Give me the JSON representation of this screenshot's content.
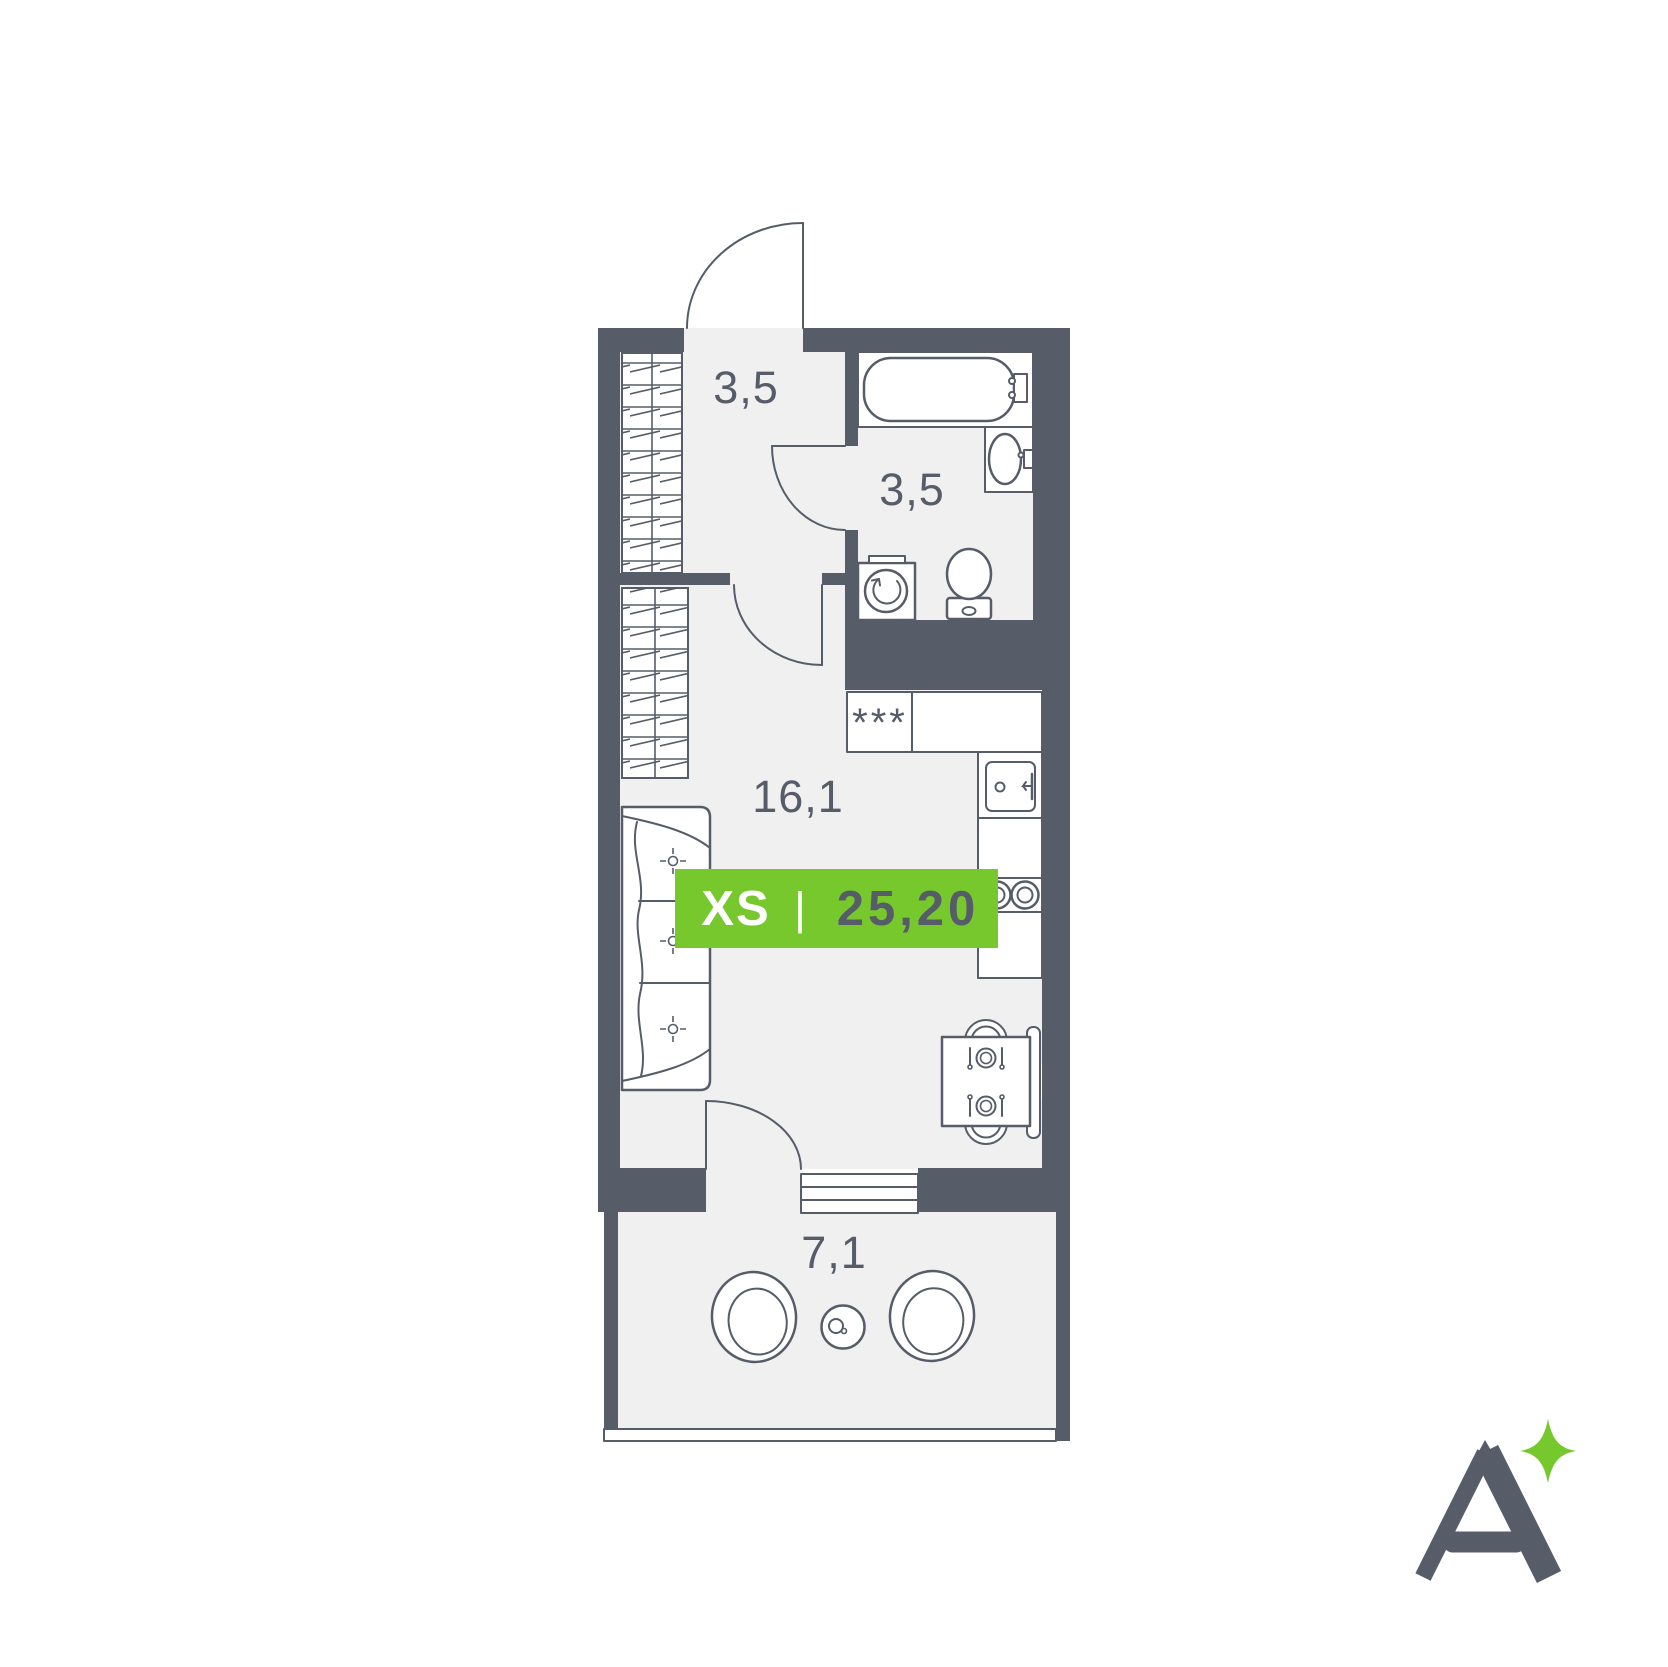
{
  "canvas": {
    "width": 1668,
    "height": 1667,
    "background": "#FFFFFF"
  },
  "palette": {
    "wall": "#565D68",
    "floor": "#F0F0F1",
    "fixture_fill": "#FFFFFF",
    "green": "#76C82D",
    "label_text": "#565D68",
    "badge_text_light": "#FFFFFF",
    "badge_text_dark": "#565D68"
  },
  "rooms": {
    "hallway": {
      "area": "3,5"
    },
    "bathroom": {
      "area": "3,5"
    },
    "living_kitchen": {
      "area": "16,1"
    },
    "balcony": {
      "area": "7,1"
    }
  },
  "badge": {
    "size_label": "XS",
    "divider": "|",
    "total_area": "25,20"
  },
  "kitchen": {
    "freezer_symbol": "***"
  },
  "logo": {
    "letter": "A"
  }
}
